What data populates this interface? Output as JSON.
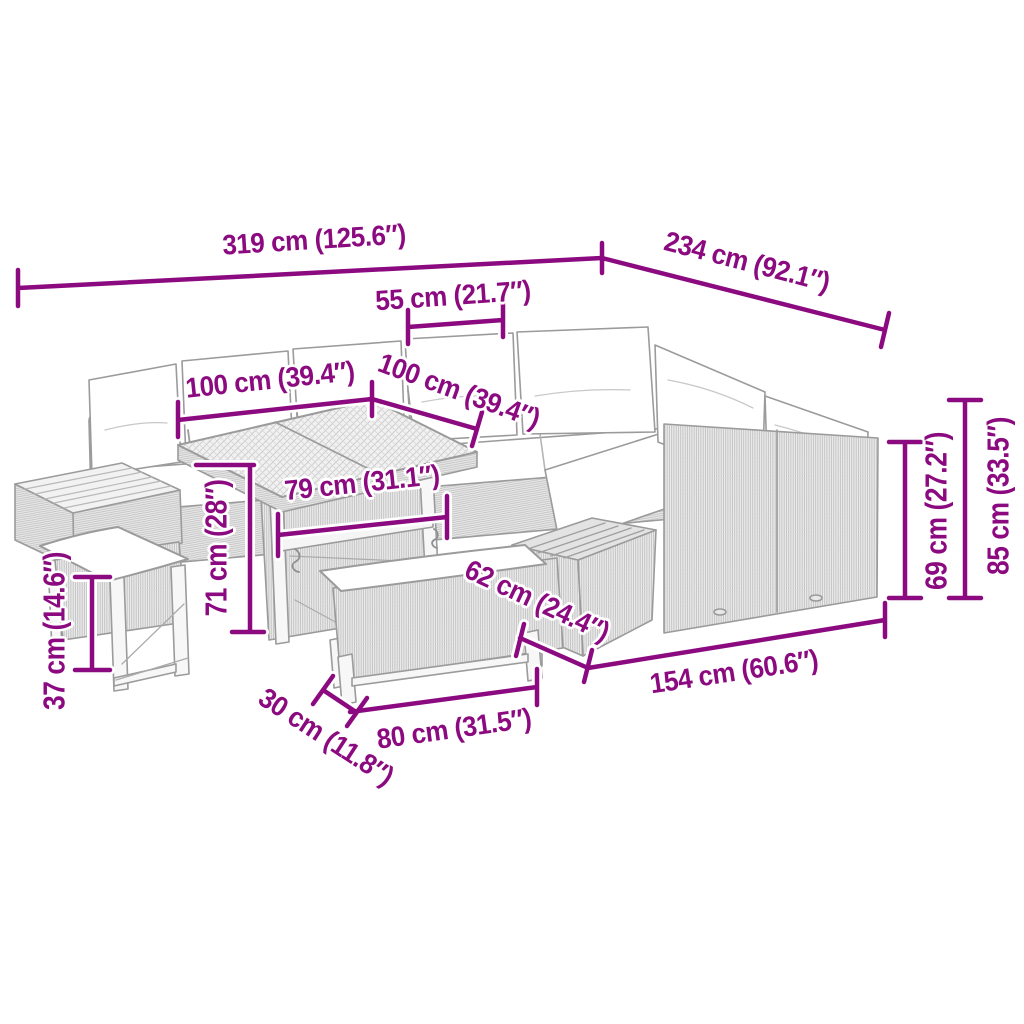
{
  "page": {
    "type": "furniture dimension diagram",
    "accent_color": "#8C0A80",
    "lineart_color": "#9B9B9B",
    "background": "#FFFFFF"
  },
  "furniture": {
    "description": "L-shaped rattan garden lounge set with corner sofa, white cushions, dining table with woven top, two wooden-top corner tables, a stool and a bench",
    "parts": [
      "corner-sofa",
      "dining-table",
      "left-corner-table",
      "right-corner-table",
      "stool",
      "bench"
    ]
  },
  "dimensions": {
    "total_width": "319 cm (125.6″)",
    "total_depth": "234 cm (92.1″)",
    "back_cushion_width": "55 cm (21.7″)",
    "table_length": "100 cm (39.4″)",
    "table_depth": "100 cm (39.4″)",
    "table_top_inner": "79 cm (31.1″)",
    "table_height": "71 cm (28″)",
    "stool_height": "37 cm (14.6″)",
    "bench_depth": "30 cm (11.8″)",
    "bench_length": "80 cm (31.5″)",
    "corner_table_depth": "62 cm (24.4″)",
    "right_sofa_length": "154 cm (60.6″)",
    "backrest_height": "69 cm (27.2″)",
    "total_height": "85 cm (33.5″)"
  }
}
